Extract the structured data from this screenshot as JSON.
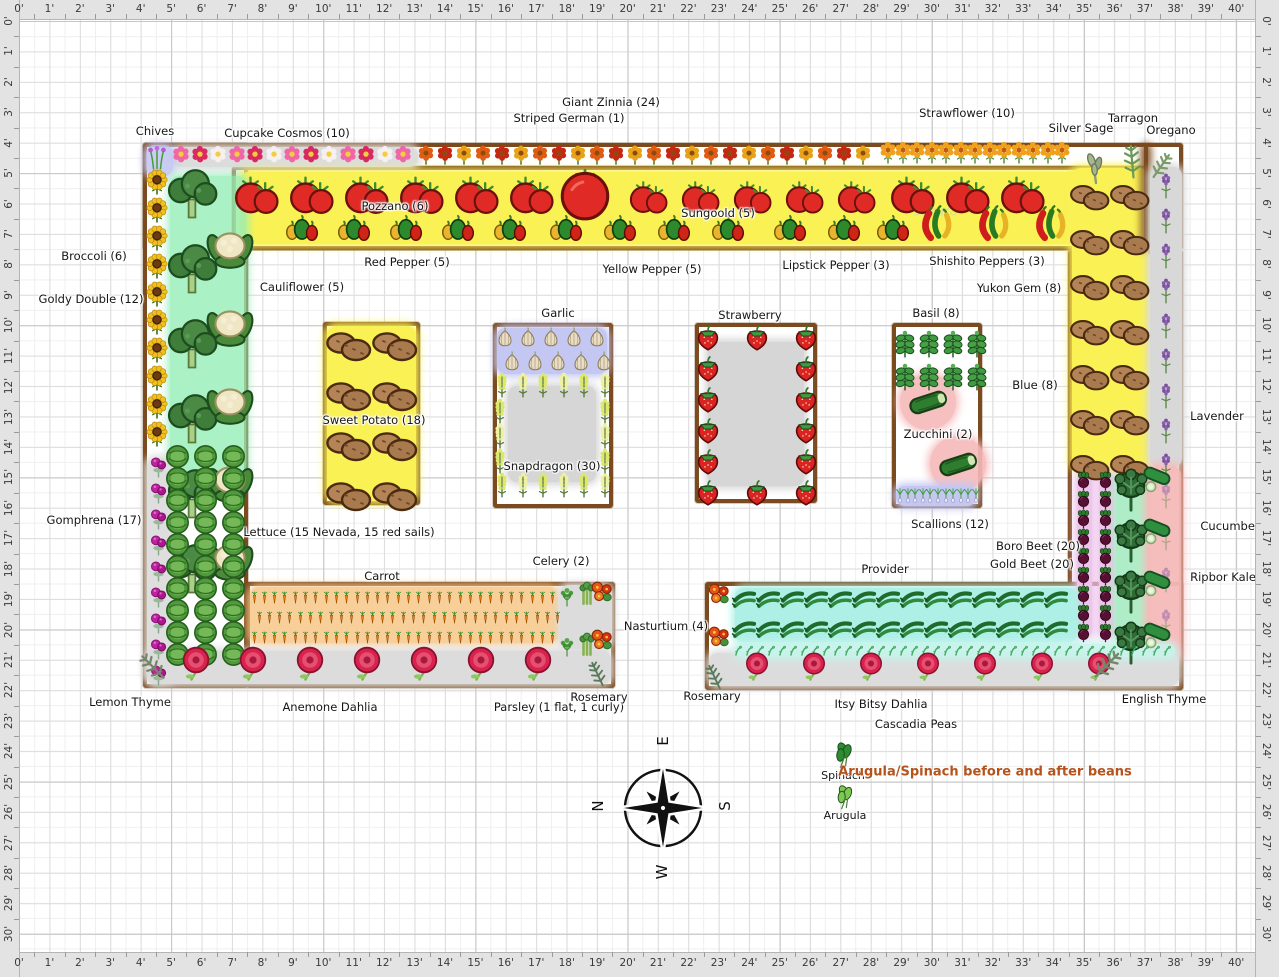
{
  "app": {
    "type": "garden-planner-plan"
  },
  "rulers": {
    "unit": "'",
    "horizontal": {
      "min": 0,
      "max": 40
    },
    "vertical": {
      "min": 0,
      "max": 30
    }
  },
  "compass": {
    "top": "E",
    "left": "N",
    "right": "S",
    "bottom": "W"
  },
  "note": {
    "text": "Arugula/Spinach before and after beans",
    "color": "#b4531c"
  },
  "watermark": {
    "text": "Sakura"
  },
  "colors": {
    "bed_border": "#7b4a1e",
    "yellow": "#faf155",
    "cyan": "#aef0e6",
    "green": "#96eeb8",
    "pink": "#f6baba",
    "violet": "#eec4ec",
    "periwinkle": "#c4c7f2",
    "orange": "#f8c98f",
    "gray": "#dcdcdc",
    "mint": "#a6ecc2"
  },
  "labels": [
    {
      "t": "Chives",
      "x": 155,
      "y": 131
    },
    {
      "t": "Cupcake Cosmos (10)",
      "x": 287,
      "y": 133
    },
    {
      "t": "Giant Zinnia (24)",
      "x": 611,
      "y": 102
    },
    {
      "t": "Striped German (1)",
      "x": 569,
      "y": 118
    },
    {
      "t": "Strawflower (10)",
      "x": 967,
      "y": 113
    },
    {
      "t": "Silver Sage",
      "x": 1081,
      "y": 128
    },
    {
      "t": "Tarragon",
      "x": 1133,
      "y": 118
    },
    {
      "t": "Oregano",
      "x": 1171,
      "y": 130
    },
    {
      "t": "Pozzano (6)",
      "x": 395,
      "y": 206
    },
    {
      "t": "Sungoold (5)",
      "x": 718,
      "y": 213
    },
    {
      "t": "Red Pepper (5)",
      "x": 407,
      "y": 262
    },
    {
      "t": "Yellow Pepper (5)",
      "x": 652,
      "y": 269
    },
    {
      "t": "Lipstick Pepper (3)",
      "x": 836,
      "y": 265
    },
    {
      "t": "Shishito Peppers (3)",
      "x": 987,
      "y": 261
    },
    {
      "t": "Yukon Gem (8)",
      "x": 1019,
      "y": 288
    },
    {
      "t": "Broccoli (6)",
      "x": 94,
      "y": 256
    },
    {
      "t": "Goldy Double (12)",
      "x": 91,
      "y": 299
    },
    {
      "t": "Cauliflower (5)",
      "x": 302,
      "y": 287
    },
    {
      "t": "Gomphrena (17)",
      "x": 94,
      "y": 520
    },
    {
      "t": "Garlic",
      "x": 558,
      "y": 313
    },
    {
      "t": "Sweet Potato (18)",
      "x": 374,
      "y": 420
    },
    {
      "t": "Snapdragon (30)",
      "x": 552,
      "y": 466
    },
    {
      "t": "Strawberry",
      "x": 750,
      "y": 315
    },
    {
      "t": "Basil (8)",
      "x": 936,
      "y": 313
    },
    {
      "t": "Zucchini (2)",
      "x": 938,
      "y": 434
    },
    {
      "t": "Scallions (12)",
      "x": 950,
      "y": 524
    },
    {
      "t": "Blue (8)",
      "x": 1035,
      "y": 385
    },
    {
      "t": "Lavender",
      "x": 1217,
      "y": 416
    },
    {
      "t": "Cucumber (8)",
      "x": 1240,
      "y": 526
    },
    {
      "t": "Boro Beet (20)",
      "x": 1038,
      "y": 546
    },
    {
      "t": "Gold Beet (20)",
      "x": 1032,
      "y": 564
    },
    {
      "t": "Ripbor Kale (4)",
      "x": 1233,
      "y": 577
    },
    {
      "t": "Lettuce (15 Nevada, 15 red sails)",
      "x": 339,
      "y": 532
    },
    {
      "t": "Celery (2)",
      "x": 561,
      "y": 561
    },
    {
      "t": "Carrot",
      "x": 382,
      "y": 576
    },
    {
      "t": "Nasturtium (4)",
      "x": 666,
      "y": 626
    },
    {
      "t": "Provider",
      "x": 885,
      "y": 569
    },
    {
      "t": "Anemone Dahlia",
      "x": 330,
      "y": 707
    },
    {
      "t": "Parsley (1 flat, 1 curly)",
      "x": 559,
      "y": 707
    },
    {
      "t": "Rosemary",
      "x": 599,
      "y": 697
    },
    {
      "t": "Rosemary",
      "x": 712,
      "y": 696
    },
    {
      "t": "Itsy Bitsy Dahlia",
      "x": 881,
      "y": 704
    },
    {
      "t": "English Thyme",
      "x": 1164,
      "y": 699
    },
    {
      "t": "Cascadia Peas",
      "x": 916,
      "y": 724
    },
    {
      "t": "Lemon Thyme",
      "x": 130,
      "y": 702
    },
    {
      "t": "Spinach",
      "x": 843,
      "y": 776,
      "fs": 11
    },
    {
      "t": "Arugula",
      "x": 845,
      "y": 816,
      "fs": 11
    }
  ],
  "beds": [
    {
      "name": "bed-top",
      "x": 143,
      "y": 143,
      "w": 1040,
      "h": 107,
      "fill": "#ffffff"
    },
    {
      "name": "bed-left",
      "x": 143,
      "y": 143,
      "w": 105,
      "h": 545,
      "fill": "#ffffff"
    },
    {
      "name": "bed-right",
      "x": 1068,
      "y": 250,
      "w": 115,
      "h": 440,
      "fill": "#ffffff"
    },
    {
      "name": "bed-bottom-left",
      "x": 246,
      "y": 582,
      "w": 369,
      "h": 106,
      "fill": "#ffffff"
    },
    {
      "name": "bed-bottom-right",
      "x": 705,
      "y": 582,
      "w": 478,
      "h": 108,
      "fill": "#ffffff"
    },
    {
      "name": "bed-tomato-pepper",
      "x": 232,
      "y": 166,
      "w": 916,
      "h": 84,
      "fill": "none"
    },
    {
      "name": "bed-sweet-potato",
      "x": 323,
      "y": 322,
      "w": 97,
      "h": 183,
      "fill": "#ffffff"
    },
    {
      "name": "bed-garlic-snapdragon",
      "x": 493,
      "y": 323,
      "w": 120,
      "h": 185,
      "fill": "#ffffff"
    },
    {
      "name": "bed-strawberry",
      "x": 695,
      "y": 323,
      "w": 122,
      "h": 180,
      "fill": "#ffffff"
    },
    {
      "name": "bed-basil-zucchini",
      "x": 892,
      "y": 323,
      "w": 90,
      "h": 185,
      "fill": "#ffffff"
    }
  ],
  "highlights": [
    {
      "name": "cosmos-strip",
      "x": 172,
      "y": 147,
      "w": 246,
      "h": 20,
      "c": "#dcdcdc"
    },
    {
      "name": "chives-strip",
      "x": 146,
      "y": 145,
      "w": 27,
      "h": 31,
      "c": "#c4c7f2",
      "o": 0.9
    },
    {
      "name": "tomato-yellow",
      "x": 240,
      "y": 172,
      "w": 900,
      "h": 72,
      "c": "#faf155"
    },
    {
      "name": "right-column-yellow",
      "x": 1072,
      "y": 168,
      "w": 76,
      "h": 302,
      "c": "#faf155"
    },
    {
      "name": "lavender-divider-bar",
      "x": 1144,
      "y": 146,
      "w": 4,
      "h": 102,
      "c": "#7b4a1e"
    },
    {
      "name": "broccoli-green",
      "x": 170,
      "y": 176,
      "w": 76,
      "h": 300,
      "c": "#96eeb8",
      "o": 0.8
    },
    {
      "name": "gomphrena-gray",
      "x": 147,
      "y": 458,
      "w": 27,
      "h": 224,
      "c": "#dedede"
    },
    {
      "name": "lavender-gray",
      "x": 1150,
      "y": 167,
      "w": 32,
      "h": 300,
      "c": "#d8d8d8"
    },
    {
      "name": "beet-violet-1",
      "x": 1077,
      "y": 472,
      "w": 15,
      "h": 166,
      "c": "#eec4ec"
    },
    {
      "name": "beet-violet-2",
      "x": 1099,
      "y": 472,
      "w": 15,
      "h": 166,
      "c": "#eec4ec"
    },
    {
      "name": "kale-mint",
      "x": 1116,
      "y": 474,
      "w": 31,
      "h": 170,
      "c": "#a6ecc2",
      "o": 0.9
    },
    {
      "name": "cucumber-pink",
      "x": 1147,
      "y": 466,
      "w": 34,
      "h": 196,
      "c": "#f6baba",
      "o": 0.95
    },
    {
      "name": "garlic-periwinkle",
      "x": 497,
      "y": 328,
      "w": 110,
      "h": 46,
      "c": "#c4c7f2"
    },
    {
      "name": "snapdragon-gray",
      "x": 508,
      "y": 386,
      "w": 88,
      "h": 96,
      "c": "#d6d6d6"
    },
    {
      "name": "strawberry-gray",
      "x": 708,
      "y": 342,
      "w": 96,
      "h": 144,
      "c": "#d6d6d6"
    },
    {
      "name": "zucchini-pink-1",
      "x": 900,
      "y": 374,
      "w": 56,
      "h": 56,
      "c": "#f6baba",
      "o": 0.9,
      "round": 1
    },
    {
      "name": "zucchini-pink-2",
      "x": 930,
      "y": 436,
      "w": 56,
      "h": 56,
      "c": "#f6baba",
      "o": 0.9,
      "round": 1
    },
    {
      "name": "scallion-periwinkle",
      "x": 896,
      "y": 486,
      "w": 80,
      "h": 20,
      "c": "#c4c7f2"
    },
    {
      "name": "sweet-potato-yellow",
      "x": 327,
      "y": 326,
      "w": 89,
      "h": 175,
      "c": "#faf155"
    },
    {
      "name": "carrot-orange",
      "x": 250,
      "y": 587,
      "w": 308,
      "h": 56,
      "c": "#f8c98f",
      "o": 0.9
    },
    {
      "name": "celery-gray",
      "x": 560,
      "y": 585,
      "w": 52,
      "h": 64,
      "c": "#dcdcdc"
    },
    {
      "name": "dahlia-gray-left",
      "x": 147,
      "y": 651,
      "w": 464,
      "h": 33,
      "c": "#dcdcdc"
    },
    {
      "name": "dahlia-gray-right",
      "x": 709,
      "y": 653,
      "w": 470,
      "h": 33,
      "c": "#dcdcdc"
    },
    {
      "name": "bean-cyan",
      "x": 735,
      "y": 588,
      "w": 342,
      "h": 54,
      "c": "#aef0e6"
    },
    {
      "name": "pea-cyan",
      "x": 735,
      "y": 644,
      "w": 440,
      "h": 13,
      "c": "#c6f4ec",
      "o": 0.9
    }
  ],
  "plants": [
    {
      "type": "chives",
      "x": 157,
      "y": 157,
      "s": 28
    },
    {
      "type": "cosmos",
      "x": 181,
      "y": 156,
      "n": 13,
      "dx": 18.5,
      "s": 22
    },
    {
      "type": "zinnia",
      "x": 426,
      "y": 155,
      "n": 24,
      "dx": 19,
      "s": 22
    },
    {
      "type": "strawflower",
      "x": 888,
      "y": 152,
      "n": 13,
      "dx": 14.5,
      "s": 24
    },
    {
      "type": "sage",
      "x": 1096,
      "y": 168,
      "s": 36
    },
    {
      "type": "tarragon",
      "x": 1132,
      "y": 160,
      "s": 38
    },
    {
      "type": "oregano",
      "x": 1162,
      "y": 165,
      "s": 32
    },
    {
      "type": "tomato",
      "x": 256,
      "y": 196,
      "n": 6,
      "dx": 55,
      "s": 44
    },
    {
      "type": "bigtomato",
      "x": 585,
      "y": 194,
      "s": 52
    },
    {
      "type": "tomato",
      "x": 648,
      "y": 198,
      "n": 5,
      "dx": 52,
      "s": 38
    },
    {
      "type": "tomato",
      "x": 912,
      "y": 196,
      "n": 3,
      "dx": 55,
      "s": 44
    },
    {
      "type": "pepper3",
      "x": 302,
      "y": 228,
      "n": 5,
      "dx": 52,
      "s": 34
    },
    {
      "type": "pepper3",
      "x": 566,
      "y": 228,
      "n": 4,
      "dx": 54,
      "s": 34
    },
    {
      "type": "pepper3",
      "x": 790,
      "y": 228,
      "n": 2,
      "dx": 54,
      "s": 34
    },
    {
      "type": "pepper3",
      "x": 893,
      "y": 228,
      "s": 34
    },
    {
      "type": "chili",
      "x": 936,
      "y": 222,
      "n": 3,
      "dx": 57,
      "s": 42
    },
    {
      "type": "sunflower",
      "x": 157,
      "y": 182,
      "n": 10,
      "dy": 28,
      "s": 26
    },
    {
      "type": "gomphrena",
      "x": 158,
      "y": 466,
      "n": 9,
      "dy": 26,
      "s": 25
    },
    {
      "type": "broccoli",
      "x": 192,
      "y": 195,
      "n": 6,
      "dy": 75,
      "s": 54
    },
    {
      "type": "cauliflower",
      "x": 230,
      "y": 248,
      "n": 5,
      "dy": 78,
      "s": 50
    },
    {
      "type": "cabbage",
      "x": 177,
      "y": 456,
      "n": 30,
      "cols": 3,
      "dx": 28,
      "dy": 22,
      "s": 27
    },
    {
      "type": "potato",
      "x": 1090,
      "y": 198,
      "n": 14,
      "cols": 2,
      "dx": 40,
      "dy": 45,
      "s": 42
    },
    {
      "type": "lavender",
      "x": 1166,
      "y": 185,
      "n": 9,
      "dy": 35,
      "s": 28
    },
    {
      "type": "lavender",
      "x": 1166,
      "y": 495,
      "n": 4,
      "dy": 42,
      "s": 28,
      "o": 0.45
    },
    {
      "type": "beet",
      "x": 1083,
      "y": 480,
      "n": 18,
      "cols": 2,
      "dx": 22,
      "dy": 19,
      "s": 19
    },
    {
      "type": "kale",
      "x": 1131,
      "y": 490,
      "n": 4,
      "dy": 51,
      "s": 44
    },
    {
      "type": "cucumber",
      "x": 1158,
      "y": 478,
      "n": 4,
      "dy": 52,
      "s": 38
    },
    {
      "type": "carrot",
      "x": 254,
      "y": 597,
      "n": 30,
      "dx": 10.3,
      "s": 15
    },
    {
      "type": "carrot",
      "x": 259,
      "y": 617,
      "n": 30,
      "dx": 10.3,
      "s": 15
    },
    {
      "type": "carrot",
      "x": 254,
      "y": 637,
      "n": 30,
      "dx": 10.3,
      "s": 15
    },
    {
      "type": "parsley",
      "x": 567,
      "y": 596,
      "s": 24
    },
    {
      "type": "parsley",
      "x": 567,
      "y": 646,
      "s": 24
    },
    {
      "type": "celery",
      "x": 587,
      "y": 592,
      "s": 28
    },
    {
      "type": "celery",
      "x": 587,
      "y": 643,
      "s": 28
    },
    {
      "type": "nasturtium",
      "x": 602,
      "y": 592,
      "s": 28
    },
    {
      "type": "nasturtium",
      "x": 602,
      "y": 640,
      "s": 28
    },
    {
      "type": "dahlia",
      "x": 196,
      "y": 663,
      "n": 7,
      "dx": 57,
      "s": 36
    },
    {
      "type": "lemonthyme",
      "x": 152,
      "y": 666,
      "s": 36
    },
    {
      "type": "rosemary",
      "x": 597,
      "y": 673,
      "s": 30
    },
    {
      "type": "nasturtium",
      "x": 719,
      "y": 594,
      "s": 28
    },
    {
      "type": "nasturtium",
      "x": 719,
      "y": 637,
      "s": 28
    },
    {
      "type": "rosemary",
      "x": 714,
      "y": 676,
      "s": 30
    },
    {
      "type": "bean",
      "x": 744,
      "y": 599,
      "n": 14,
      "dx": 24,
      "s": 27
    },
    {
      "type": "bean",
      "x": 744,
      "y": 629,
      "n": 14,
      "dx": 24,
      "s": 27
    },
    {
      "type": "pea",
      "x": 740,
      "y": 651,
      "n": 40,
      "dx": 11,
      "s": 14
    },
    {
      "type": "dahlia",
      "x": 757,
      "y": 666,
      "n": 7,
      "dx": 57,
      "s": 30
    },
    {
      "type": "englishthyme",
      "x": 1108,
      "y": 664,
      "s": 38
    },
    {
      "type": "potato",
      "x": 349,
      "y": 347,
      "n": 8,
      "cols": 2,
      "dx": 46,
      "dy": 50,
      "s": 48
    },
    {
      "type": "garlic",
      "x": 505,
      "y": 338,
      "n": 5,
      "dx": 23,
      "s": 22
    },
    {
      "type": "garlic",
      "x": 512,
      "y": 362,
      "n": 5,
      "dx": 23,
      "s": 22
    },
    {
      "type": "snapdragon",
      "x": 502,
      "y": 384,
      "n": 6,
      "dx": 20.5,
      "s": 28
    },
    {
      "type": "snapdragon",
      "x": 502,
      "y": 484,
      "n": 6,
      "dx": 20.5,
      "s": 28
    },
    {
      "type": "snapdragon",
      "x": 500,
      "y": 410,
      "n": 3,
      "dy": 25,
      "s": 28
    },
    {
      "type": "snapdragon",
      "x": 605,
      "y": 410,
      "n": 3,
      "dy": 25,
      "s": 28
    },
    {
      "type": "strawberry",
      "x": 708,
      "y": 336,
      "n": 6,
      "dy": 31,
      "s": 30
    },
    {
      "type": "strawberry",
      "x": 806,
      "y": 336,
      "n": 6,
      "dy": 31,
      "s": 30
    },
    {
      "type": "strawberry",
      "x": 757,
      "y": 336,
      "s": 30
    },
    {
      "type": "strawberry",
      "x": 757,
      "y": 491,
      "s": 30
    },
    {
      "type": "basil",
      "x": 905,
      "y": 343,
      "n": 8,
      "cols": 4,
      "dx": 24,
      "dy": 33,
      "s": 30
    },
    {
      "type": "zucchini",
      "x": 928,
      "y": 402,
      "s": 46
    },
    {
      "type": "zucchini",
      "x": 958,
      "y": 464,
      "s": 46
    },
    {
      "type": "scallion",
      "x": 900,
      "y": 494,
      "n": 11,
      "dx": 7.6,
      "s": 18
    },
    {
      "type": "spinach",
      "x": 843,
      "y": 755,
      "s": 30
    },
    {
      "type": "arugula",
      "x": 844,
      "y": 797,
      "s": 28
    }
  ]
}
